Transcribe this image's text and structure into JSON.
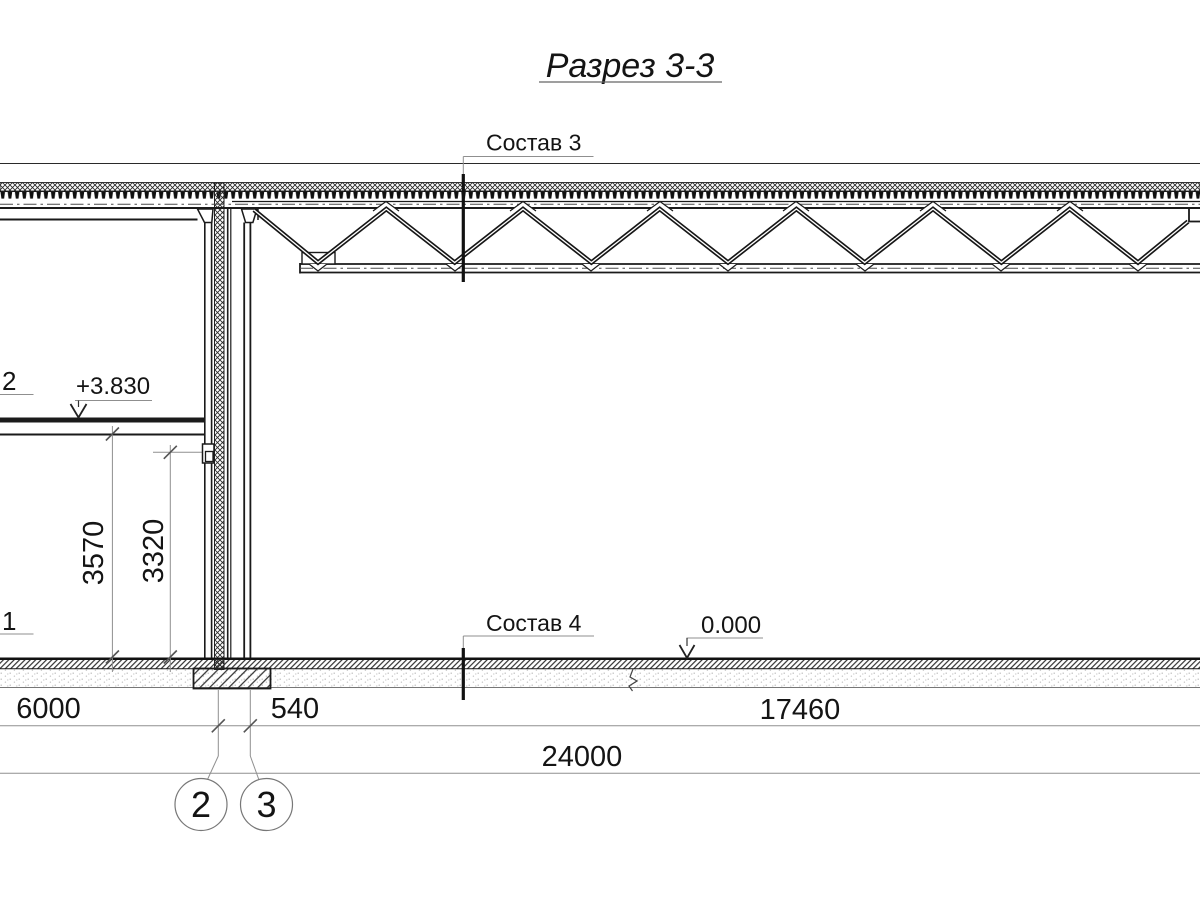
{
  "drawing": {
    "title": "Разрез 3-3",
    "section_callouts": [
      {
        "label": "Состав 3"
      },
      {
        "label": "Состав 4"
      }
    ],
    "elevation_marks": [
      {
        "value": "+3.830"
      },
      {
        "value": "0.000"
      }
    ],
    "dimensions": {
      "horizontal_mm": [
        {
          "label": "6000"
        },
        {
          "label": "540"
        },
        {
          "label": "17460"
        }
      ],
      "overall_mm": {
        "label": "24000"
      },
      "vertical_mm": [
        {
          "label": "3570"
        },
        {
          "label": "3320"
        }
      ]
    },
    "position_labels": [
      {
        "label": "2"
      },
      {
        "label": "1"
      }
    ],
    "grid_axes": [
      {
        "label": "2"
      },
      {
        "label": "3"
      }
    ],
    "colors": {
      "line": "#1a1a1a",
      "dimension": "#8f8f8f",
      "background": "#ffffff"
    }
  }
}
